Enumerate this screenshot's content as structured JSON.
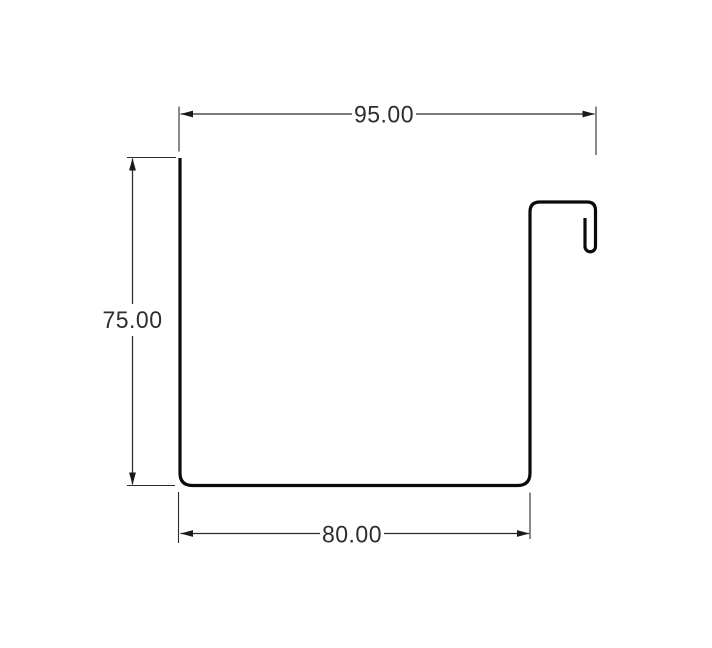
{
  "diagram": {
    "type": "technical-profile-drawing",
    "description": "CAD cross-section of a channel / gutter profile with hook return at top right",
    "dimensions": {
      "top_width": "95.00",
      "left_height": "75.00",
      "bottom_width": "80.00"
    },
    "colors": {
      "background": "#ffffff",
      "profile_stroke": "#0a0a0a",
      "dimension_stroke": "#2b2b2b",
      "dimension_text": "#2e2e2e"
    }
  }
}
